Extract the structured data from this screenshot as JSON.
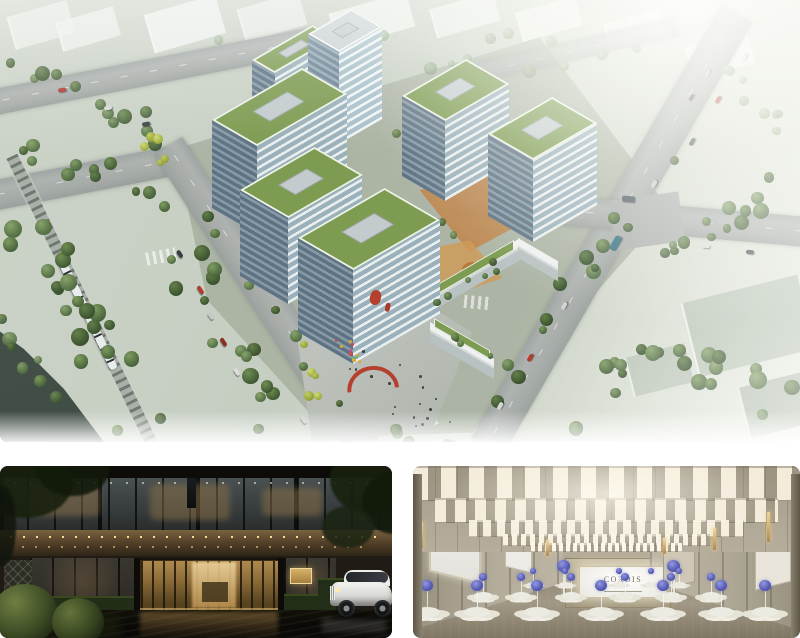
{
  "page": {
    "title": "Development renderings collage"
  },
  "panels": {
    "aerial": {
      "label": "Aerial masterplan rendering",
      "description": "Bird's-eye rendering of an office park with green-roofed glass buildings, tree-lined roads, an elevated light-rail line, and a public plaza with red sculptures and balloons"
    },
    "entrance": {
      "label": "Hotel entrance rendering",
      "description": "Dusk view of the hotel drop-off with bronze canopy, glowing bronze-framed doors, clipped topiary spheres and a white luxury sedan"
    },
    "ballroom": {
      "label": "Grand ballroom rendering",
      "description": "Pillarless ballroom with rows of rectangular chandeliers, white banquet seating, violet floral centerpieces and CORDIS branded screens",
      "stage_screen_text": "CORDIS",
      "wall_screen_text": "CORDIS"
    }
  },
  "colors": {
    "background_gap": "#ffffff",
    "roof_green": "#7d9b51",
    "plaza_red": "#b5402e",
    "centerpiece_violet": "#5a5fb8",
    "canopy_bronze": "#6b5636"
  }
}
